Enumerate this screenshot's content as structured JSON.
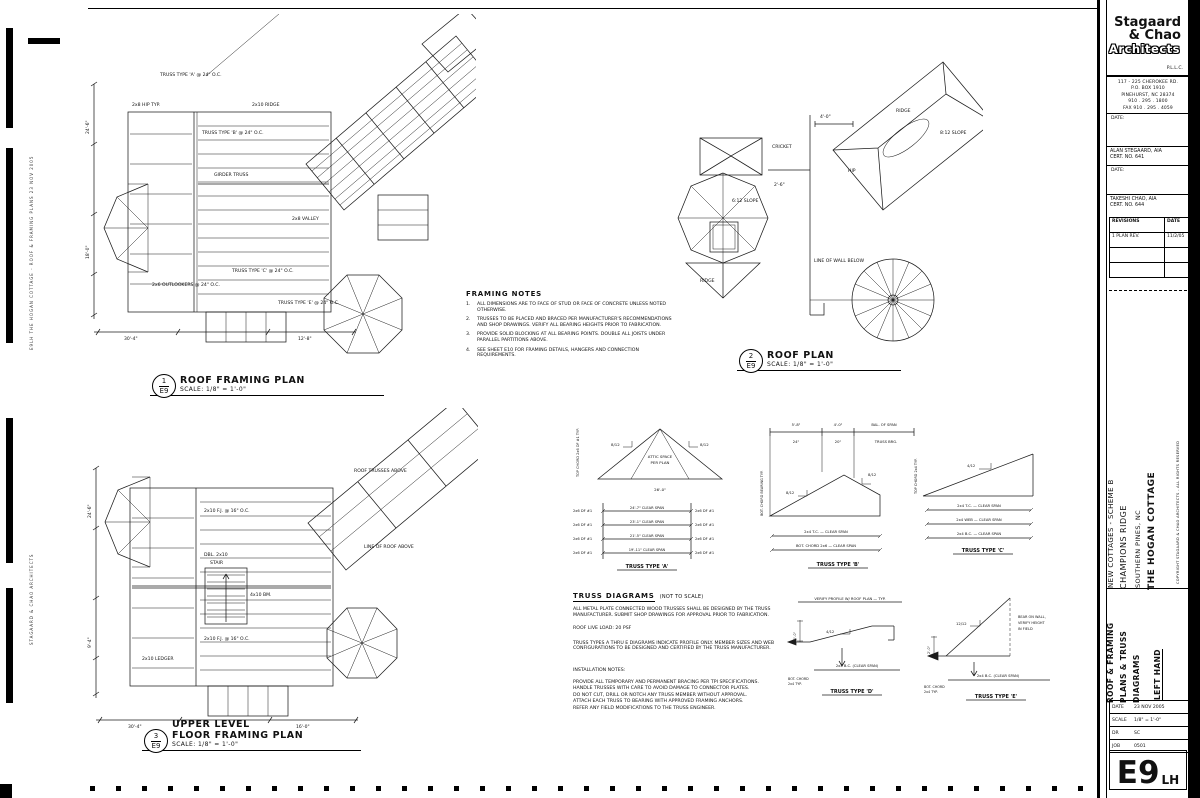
{
  "plan_labels": [
    {
      "num": "1",
      "sheet": "E9",
      "title": "ROOF FRAMING PLAN",
      "scale": "SCALE: 1/8\" = 1'-0\""
    },
    {
      "num": "2",
      "sheet": "E9",
      "title": "ROOF PLAN",
      "scale": "SCALE: 1/8\" = 1'-0\""
    },
    {
      "num": "3",
      "sheet": "E9",
      "pretitle": "UPPER LEVEL",
      "title": "FLOOR FRAMING PLAN",
      "scale": "SCALE: 1/8\" = 1'-0\""
    }
  ],
  "plan1": {
    "callouts": [
      "TRUSS TYPE 'A' @ 24\" O.C.",
      "2x10 RIDGE",
      "TRUSS TYPE 'B' @ 24\" O.C.",
      "2x8 HIP TYP.",
      "2x6 OUTLOOKERS @ 24\" O.C.",
      "TRUSS TYPE 'C' @ 24\" O.C.",
      "2x8 VALLEY",
      "TRUSS TYPE 'E' @ 24\" O.C.",
      "GIRDER TRUSS"
    ],
    "dims": [
      "24'-6\"",
      "18'-0\"",
      "30'-4\"",
      "12'-8\""
    ]
  },
  "plan2": {
    "callouts": [
      "RIDGE",
      "HIP",
      "8:12 SLOPE",
      "6:12 SLOPE",
      "CRICKET",
      "LINE OF WALL BELOW",
      "RIDGE"
    ],
    "dims": [
      "4'-0\"",
      "2'-6\""
    ]
  },
  "plan3": {
    "callouts": [
      "2x10 F.J. @ 16\" O.C.",
      "DBL. 2x10",
      "4x10 BM.",
      "STAIR",
      "2x10 LEDGER",
      "ROOF TRUSSES ABOVE",
      "2x10 F.J. @ 16\" O.C.",
      "LINE OF ROOF ABOVE"
    ],
    "dims": [
      "24'-6\"",
      "9'-4\"",
      "30'-4\"",
      "16'-0\""
    ]
  },
  "framing_notes": {
    "heading": "FRAMING NOTES",
    "items": [
      {
        "n": "1.",
        "t": "ALL DIMENSIONS ARE TO FACE OF STUD OR FACE OF CONCRETE UNLESS NOTED OTHERWISE."
      },
      {
        "n": "2.",
        "t": "TRUSSES TO BE PLACED AND BRACED PER MANUFACTURER'S RECOMMENDATIONS AND SHOP DRAWINGS. VERIFY ALL BEARING HEIGHTS PRIOR TO FABRICATION."
      },
      {
        "n": "3.",
        "t": "PROVIDE SOLID BLOCKING AT ALL BEARING POINTS. DOUBLE ALL JOISTS UNDER PARALLEL PARTITIONS ABOVE."
      },
      {
        "n": "4.",
        "t": "SEE SHEET E10 FOR FRAMING DETAILS, HANGERS AND CONNECTION REQUIREMENTS."
      }
    ]
  },
  "truss_notes": {
    "heading": "TRUSS DIAGRAMS",
    "heading_suffix": "(NOT TO SCALE)",
    "para1": "ALL METAL PLATE CONNECTED WOOD TRUSSES SHALL BE DESIGNED BY THE TRUSS MANUFACTURER. SUBMIT SHOP DRAWINGS FOR APPROVAL PRIOR TO FABRICATION.",
    "live_load": "ROOF LIVE LOAD:  20 PSF",
    "para2": "TRUSS TYPES A THRU E DIAGRAMS INDICATE PROFILE ONLY. MEMBER SIZES AND WEB CONFIGURATIONS TO BE DESIGNED AND CERTIFIED BY THE TRUSS MANUFACTURER.",
    "install_heading": "INSTALLATION NOTES:",
    "install_items": [
      "PROVIDE ALL TEMPORARY AND PERMANENT BRACING PER TPI SPECIFICATIONS.",
      "HANDLE TRUSSES WITH CARE TO AVOID DAMAGE TO CONNECTOR PLATES.",
      "DO NOT CUT, DRILL OR NOTCH ANY TRUSS MEMBER WITHOUT APPROVAL.",
      "ATTACH EACH TRUSS TO BEARING WITH APPROVED FRAMING ANCHORS.",
      "REFER ANY FIELD MODIFICATIONS TO THE TRUSS ENGINEER."
    ]
  },
  "trusses": {
    "a": {
      "caption": "TRUSS TYPE 'A'",
      "pitch_left": "8/12",
      "pitch_right": "8/12",
      "interior1": "ATTIC SPACE",
      "interior2": "PER PLAN",
      "base_dim": "26'-0\"",
      "side_note": "TOP CHORD 2x6 DF #1 TYP.",
      "rows": [
        {
          "left": "2x6 DF #1",
          "mid": "24'-7\"  CLEAR SPAN",
          "right": "2x6 DF #1"
        },
        {
          "left": "2x6 DF #1",
          "mid": "23'-1\"  CLEAR SPAN",
          "right": "2x6 DF #1"
        },
        {
          "left": "2x6 DF #1",
          "mid": "21'-5\"  CLEAR SPAN",
          "right": "2x6 DF #1"
        },
        {
          "left": "2x6 DF #1",
          "mid": "19'-11\"  CLEAR SPAN",
          "right": "2x6 DF #1"
        }
      ]
    },
    "b": {
      "caption": "TRUSS TYPE 'B'",
      "pitch_left": "8/12",
      "pitch_right": "8/12",
      "dims": [
        "5'-8\"",
        "4'-0\"",
        "BAL. OF SPAN"
      ],
      "col_notes": [
        "24\"",
        "20\"",
        "TRUSS BRG."
      ],
      "row1": "2x4 T.C.  —  CLEAR SPAN",
      "row2": "BOT. CHORD 2x6  —  CLEAR SPAN",
      "side_note": "BOT. CHORD BEARING TYP."
    },
    "c": {
      "caption": "TRUSS TYPE 'C'",
      "pitch": "4/12",
      "side_note": "TOP CHORD 2x4 TYP.",
      "row1": "2x4 T.C.  —  CLEAR SPAN",
      "row2": "2x4 WEB  —  CLEAR SPAN",
      "row3": "2x4 B.C.  —  CLEAR SPAN"
    },
    "d": {
      "caption": "TRUSS TYPE 'D'",
      "pitch": "4/12",
      "top_note": "VERIFY PROFILE W/ ROOF PLAN  —  TYP.",
      "row": "2x4 B.C.  (CLEAR SPAN)",
      "side_note1": "BOT. CHORD",
      "side_note2": "2x4 TYP.",
      "dim": "1'-0\""
    },
    "e": {
      "caption": "TRUSS TYPE 'E'",
      "pitch": "12/12",
      "note1": "BEAR ON WALL,",
      "note2": "VERIFY HEIGHT",
      "note3": "IN FIELD",
      "row": "2x4 B.C.  (CLEAR SPAN)",
      "side_note1": "BOT. CHORD",
      "side_note2": "2x4 TYP.",
      "dim": "2'-0\""
    }
  },
  "titleblock": {
    "logo1": "Stagaard",
    "logo2": "& Chao",
    "logo3": "Architects",
    "suffix": "P.L.L.C.",
    "address": [
      "117 - 225 CHEROKEE RD.",
      "P.O. BOX 1910",
      "PINEHURST, NC 28374",
      "910 . 295 . 1800",
      "FAX  910 . 295 . 4059"
    ],
    "date_label": "DATE:",
    "arch1_name": "ALAN STEGAARD, AIA",
    "arch1_cert": "CERT. NO. 641",
    "arch2_name": "TAKESHI CHAO, AIA",
    "arch2_cert": "CERT. NO. 644",
    "rev_col1": "REVISIONS",
    "rev_col2": "DATE",
    "rev_rows": [
      {
        "desc": "1  PLAN REV.",
        "date": "11/2/05"
      }
    ],
    "project1": "NEW COTTAGES - SCHEME B",
    "project2": "CHAMPIONS RIDGE",
    "project3": "SOUTHERN PINES, NC",
    "project4": "THE HOGAN COTTAGE",
    "copyright": "COPYRIGHT  STAGAARD & CHAO ARCHITECTS  -  ALL RIGHTS RESERVED",
    "sheet_title1": "ROOF & FRAMING",
    "sheet_title2": "PLANS & TRUSS",
    "sheet_title3": "DIAGRAMS",
    "hand": "LEFT HAND",
    "info": [
      {
        "l": "DATE",
        "v": "23 NOV 2005"
      },
      {
        "l": "SCALE",
        "v": "1/8\" = 1'-0\""
      },
      {
        "l": "DR",
        "v": "SC"
      },
      {
        "l": "JOB",
        "v": "0501"
      }
    ],
    "sheet_number": "E9",
    "sheet_hand": "LH"
  },
  "stamps": {
    "s1": "E9LH  THE HOGAN COTTAGE - ROOF & FRAMING PLANS  23 NOV 2005",
    "s2": "STAGAARD & CHAO ARCHITECTS"
  }
}
